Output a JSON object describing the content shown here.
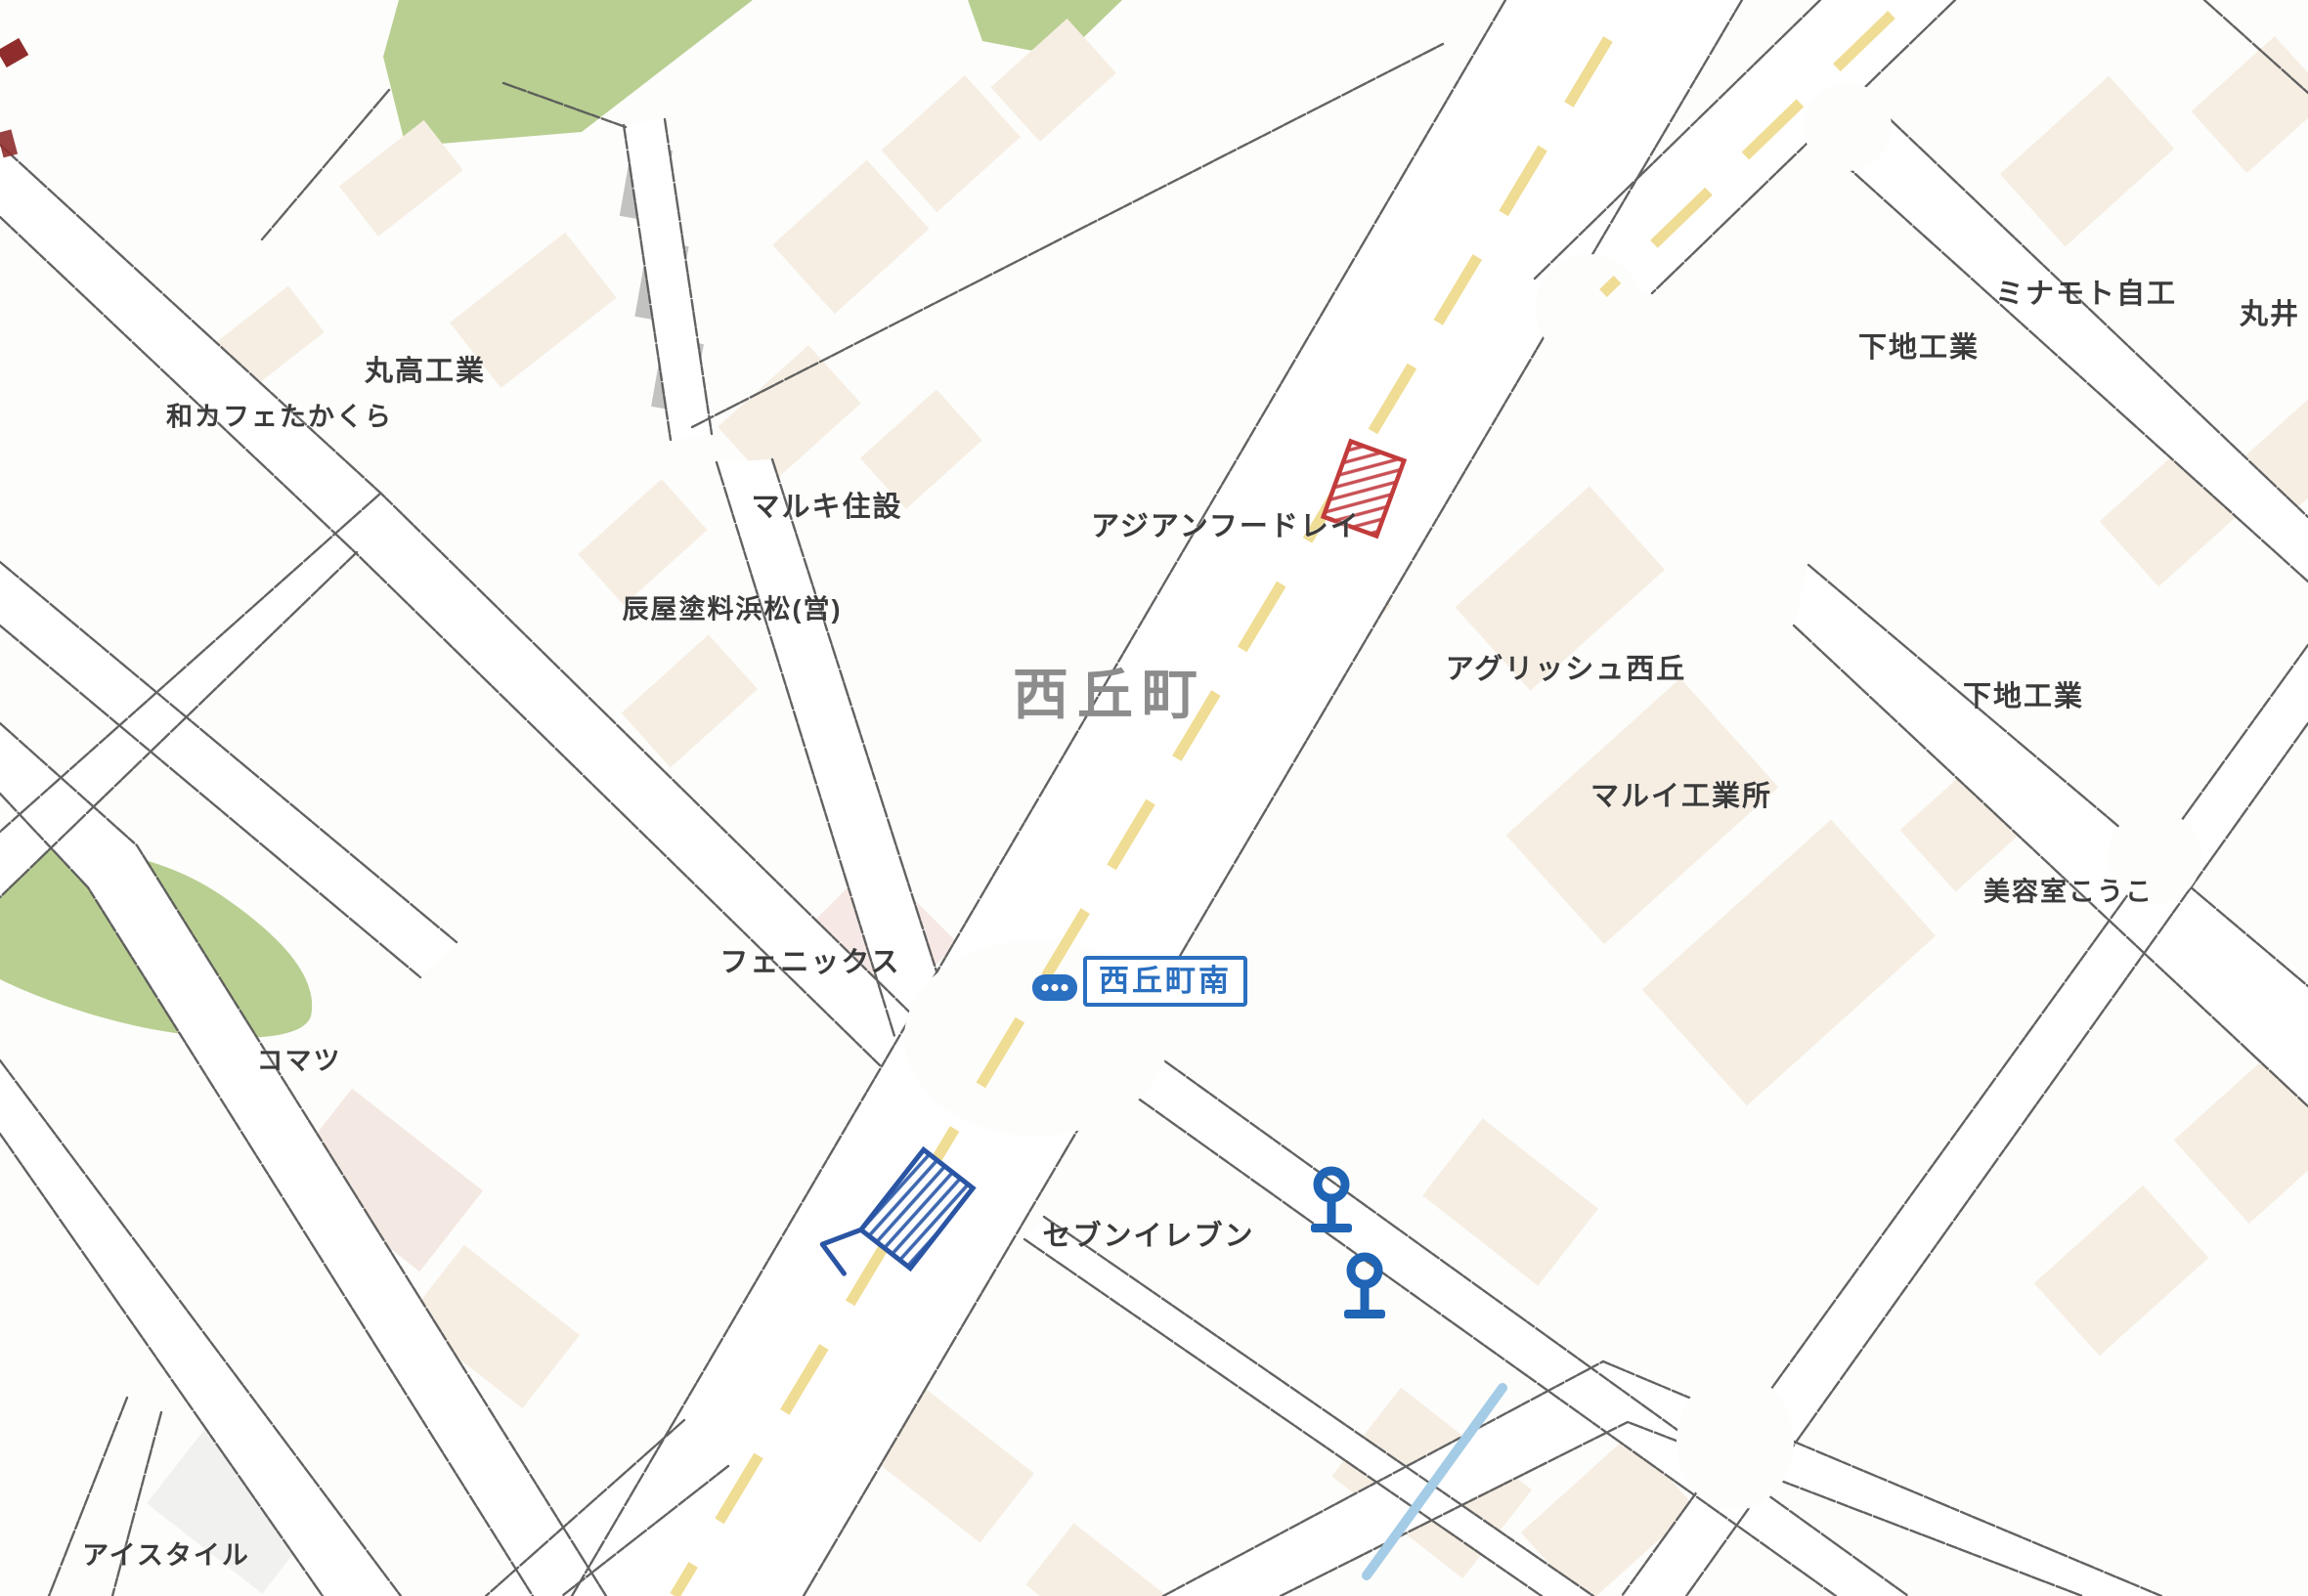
{
  "map": {
    "district": "西丘町",
    "bus_stop": {
      "name": "西丘町南",
      "icon": "bus-icon",
      "pole_icon_count": 2
    },
    "labels": {
      "marutaka_kogyo": "丸高工業",
      "wa_cafe_takakura": "和カフェたかくら",
      "maruki_jusetsu": "マルキ住設",
      "tatsuya_toryo_hamamatsu": "辰屋塗料浜松(営)",
      "asian_food_rei": "アジアンフードレイ",
      "minamoto_jiko": "ミナモト自工",
      "marui": "丸井",
      "shimoji_kogyo_north": "下地工業",
      "agrish_nishioka": "アグリッシュ西丘",
      "marui_kogyosho": "マルイ工業所",
      "shimoji_kogyo_east": "下地工業",
      "biyoshitsu_koko": "美容室こうこ",
      "phoenix": "フェニックス",
      "komatsu": "コマツ",
      "seven_eleven": "セブンイレブン",
      "ice_style": "アイスタイル"
    },
    "markers": {
      "red_hatched_marker": "red-hatched-building-marker",
      "blue_hatched_marker": "blue-hatched-building-marker",
      "bus_stop_pole_icons": "bus-stop-pole-icon",
      "stream": "stream-line"
    },
    "colors": {
      "road_line": "#565656",
      "road_center_line": "#eed98a",
      "green_area": "#b9cf92",
      "stream": "#a5cce6",
      "marker_red": "#c23b3b",
      "marker_blue": "#2a55a4",
      "bus_blue": "#2a6fc0",
      "district_text": "#8c8c8c",
      "label_text": "#3b3b3b",
      "building_fill": "#f6eee3"
    }
  }
}
